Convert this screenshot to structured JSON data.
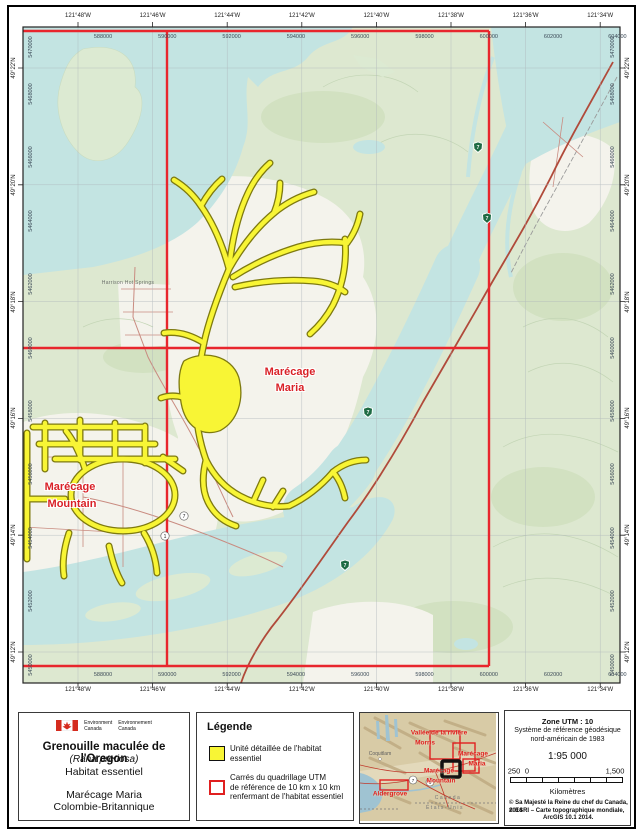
{
  "map": {
    "top_longitudes": [
      "121°48'W",
      "121°46'W",
      "121°44'W",
      "121°42'W",
      "121°40'W",
      "121°38'W",
      "121°36'W",
      "121°34'W"
    ],
    "bottom_longitudes": [
      "121°48'W",
      "121°46'W",
      "121°44'W",
      "121°42'W",
      "121°40'W",
      "121°38'W",
      "121°36'W",
      "121°34'W"
    ],
    "left_latitudes": [
      "49°22'N",
      "49°20'N",
      "49°18'N",
      "49°16'N",
      "49°14'N",
      "49°12'N"
    ],
    "right_latitudes": [
      "49°22'N",
      "49°20'N",
      "49°18'N",
      "49°16'N",
      "49°14'N",
      "49°12'N"
    ],
    "top_eastings": [
      "588000",
      "590000",
      "592000",
      "594000",
      "596000",
      "598000",
      "600000",
      "602000",
      "604000"
    ],
    "bottom_eastings": [
      "588000",
      "590000",
      "592000",
      "594000",
      "596000",
      "598000",
      "600000",
      "602000",
      "604000"
    ],
    "left_northings": [
      "5468000",
      "5466000",
      "5464000",
      "5462000",
      "5460000",
      "5458000",
      "5456000",
      "5454000",
      "5452000",
      "5450000"
    ],
    "right_northings": [
      "5468000",
      "5466000",
      "5464000",
      "5462000",
      "5460000",
      "5458000",
      "5456000",
      "5454000",
      "5452000",
      "5450000"
    ],
    "corner_northing": "5470000",
    "place_label": "Harrison Hot Springs",
    "habitat_labels": {
      "maria": [
        "Marécage",
        "Maria"
      ],
      "mountain": [
        "Marécage",
        "Mountain"
      ]
    },
    "shield_route": "7",
    "circle_routes": [
      "7",
      "1"
    ],
    "colors": {
      "water": "#c3e4e2",
      "land": "#dde8d0",
      "flats": "#f4f3ec",
      "habitat_fill": "#f8f535",
      "habitat_outline": "#7e7a10",
      "grid_red": "#e8262d",
      "road": "#b04a3a",
      "label_red": "#d92127"
    }
  },
  "title_block": {
    "dept_en": [
      "Environment",
      "Canada"
    ],
    "dept_fr": [
      "Environnement",
      "Canada"
    ],
    "title": "Grenouille maculée de l'Oregon",
    "species": "(Rana pretiosa)",
    "subtitle": "Habitat essentiel",
    "site": "Marécage Maria",
    "province": "Colombie-Britannique"
  },
  "legend": {
    "heading": "Légende",
    "item1": [
      "Unité détaillée de l'habitat",
      "essentiel"
    ],
    "item2": [
      "Carrés du quadrillage UTM",
      "de référence de 10 km x 10 km",
      "renfermant de l'habitat essentiel"
    ]
  },
  "inset": {
    "valley": [
      "Vallée de la rivière",
      "Morris"
    ],
    "maria": [
      "Marécage",
      "Maria"
    ],
    "mountain": [
      "Marécage",
      "Mountain"
    ],
    "aldergrove": "Aldergrove",
    "city": "Coquitlam",
    "canada": "Canada",
    "usa": "États-Unis",
    "routes": [
      "7",
      "1"
    ]
  },
  "info": {
    "zone": "Zone UTM : 10",
    "datum1": "Système de référence géodésique",
    "datum2": "nord-américain de 1983",
    "scale": "1:95 000",
    "bar_left": "250",
    "bar_zero": "0",
    "bar_right": "1,500",
    "units": "Kilomètres",
    "copy1": "© Sa Majesté la Reine du chef du Canada, 2014",
    "copy2": "© ESRI – Carte topographique mondiale,",
    "copy3": "ArcGIS 10.1 2014."
  }
}
